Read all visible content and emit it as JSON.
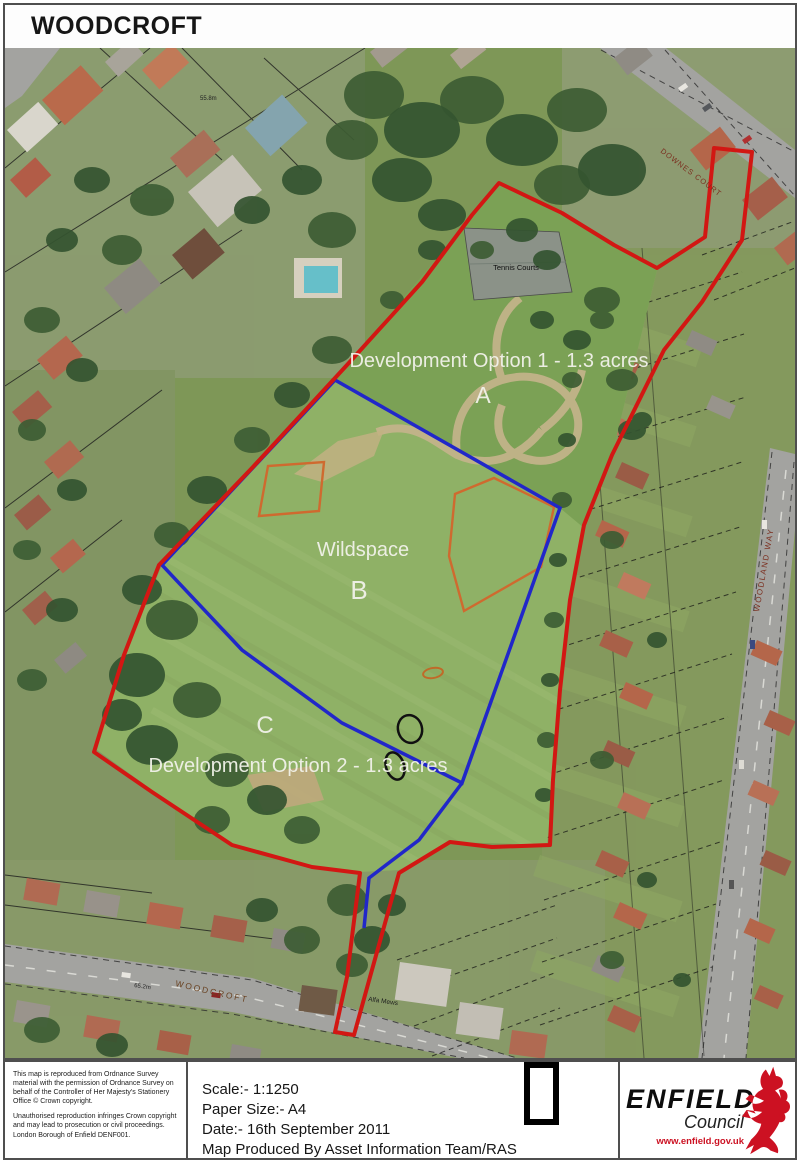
{
  "title": "WOODCROFT",
  "map": {
    "labels": {
      "option1": "Development Option 1 - 1.3 acres",
      "area_a": "A",
      "wildspace": "Wildspace",
      "area_b": "B",
      "area_c": "C",
      "option2": "Development Option 2 - 1.3 acres",
      "tennis_courts": "Tennis Courts",
      "spot_height_top": "55.8m",
      "spot_height_bottom": "65.2m",
      "street_downes_court": "DOWNES COURT",
      "street_woodland_way": "WOODLAND WAY",
      "street_woodcroft": "WOODCROFT",
      "alfa_mews": "Alfa Mews"
    },
    "overlay_colors": {
      "site_boundary_red": "#d21713",
      "wildspace_blue": "#2127c9",
      "option_orange": "#cf6a2f"
    }
  },
  "footer": {
    "copyright_para1": "This map is reproduced from Ordnance Survey material with the permission of Ordnance Survey on behalf of the Controller of Her Majesty's Stationery Office  © Crown copyright.",
    "copyright_para2": "Unauthorised reproduction infringes Crown copyright and may lead to prosecution or civil proceedings. London Borough of Enfield DENF001.",
    "scale": "Scale:- 1:1250",
    "paper_size": "Paper Size:- A4",
    "date": "Date:- 16th September 2011",
    "produced_by": "Map Produced By Asset Information Team/RAS",
    "logo": {
      "org": "ENFIELD",
      "org_sub": "Council",
      "website": "www.enfield.gov.uk"
    }
  }
}
